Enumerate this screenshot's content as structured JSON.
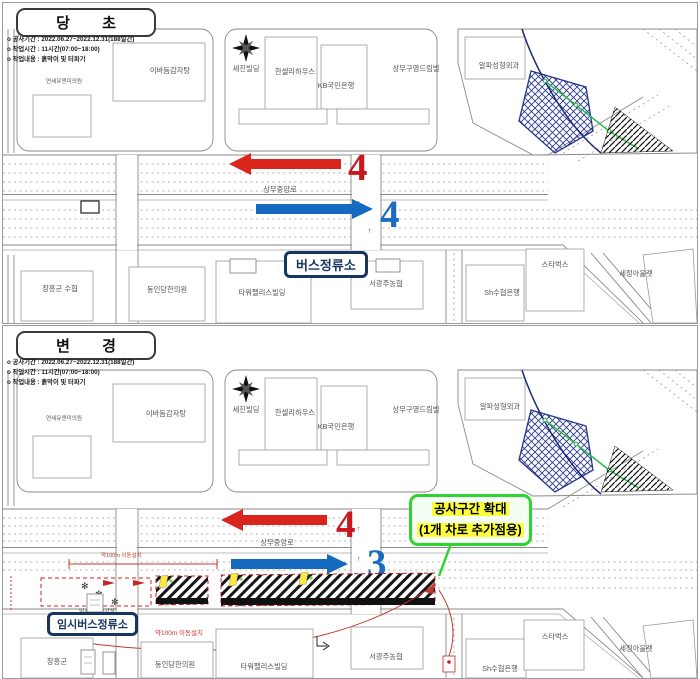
{
  "colors": {
    "red": "#c8181d",
    "blue": "#1b6cc0",
    "green": "#2fd22f",
    "yellow": "#fdff3d",
    "navy": "#17365f"
  },
  "original": {
    "header": "당 초",
    "info": [
      "o 공사기간 : 2022.06.27~2022.12.31(188일간)",
      "o 작업시간 : 11시간(07:00~18:00)",
      "o 작업내용 : 흙막이 및 터파기"
    ],
    "clinic": "연세유앤미의원",
    "road_name": "상무중앙로",
    "westbound_lanes": "4",
    "eastbound_lanes": "4",
    "bus_stop": "버스정류소",
    "buildings": [
      "이바돔감자탕",
      "세진빌딩",
      "한셀리하우스",
      "KB국민은행",
      "상무구영드림빌",
      "알파성형외과",
      "장흥군 수협",
      "동인당한의원",
      "타워팰리스빌딩",
      "서광주농협",
      "Sh수협은행",
      "스타벅스",
      "세정아울렛"
    ]
  },
  "changed": {
    "header": "변 경",
    "info": [
      "o 공사기간 : 2022.06.27~2022.12.31(188일간)",
      "o 작업시간 : 11시간(07:00~18:00)",
      "o 작업내용 : 흙막이 및 터파기"
    ],
    "clinic": "연세유앤미의원",
    "road_name": "상무중앙로",
    "westbound_lanes": "4",
    "eastbound_lanes": "3",
    "temp_bus_stop": "임시버스정류소",
    "temp_platform": "임시버스승강장",
    "move_note": "약100m 이동설치",
    "expansion": {
      "line1": "공사구간 확대",
      "line2": "(1개 차로 추가점용)"
    },
    "buildings": [
      "이바돔감자탕",
      "세진빌딩",
      "한셀리하우스",
      "KB국민은행",
      "상무구영드림빌",
      "알파성형외과",
      "장흥군",
      "동인당한의원",
      "타워팰리스빌딩",
      "서광주농협",
      "Sh수협은행",
      "스타벅스",
      "세정아울렛"
    ]
  }
}
